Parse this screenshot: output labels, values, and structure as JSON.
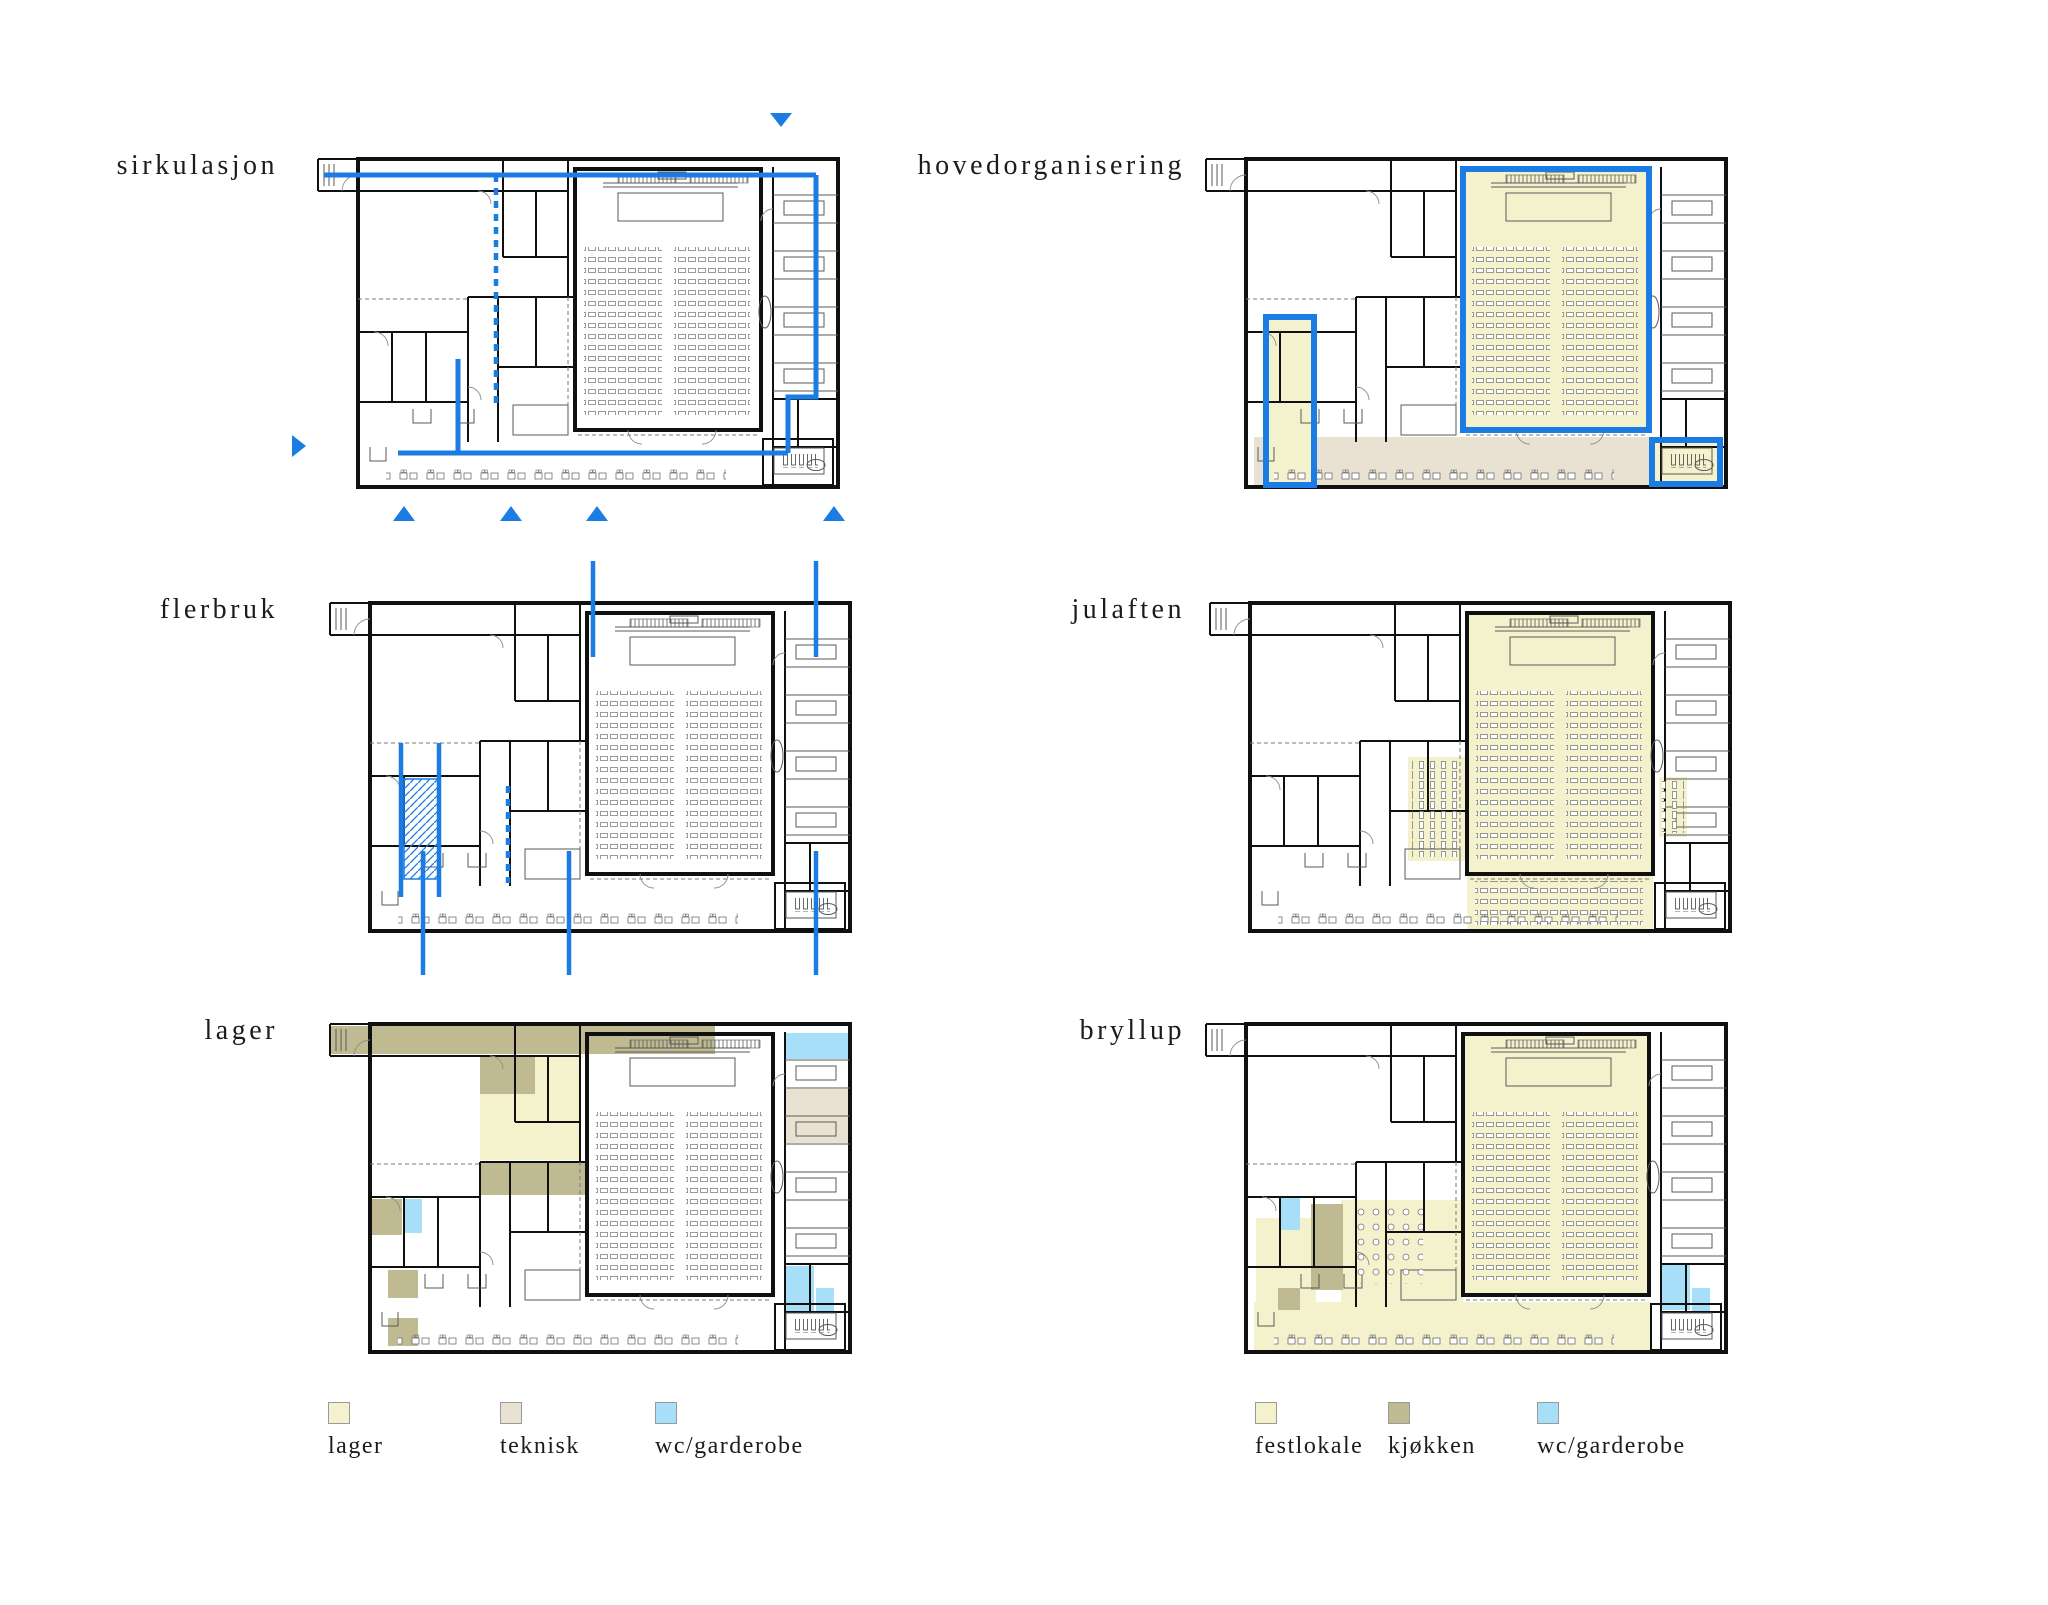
{
  "page": {
    "background": "#ffffff",
    "width": 2048,
    "height": 1605
  },
  "colors": {
    "circulation_blue": "#1b7de4",
    "pale_yellow": "#f4f1cd",
    "beige": "#e9e1d2",
    "olive": "#bfba92",
    "light_blue": "#a6dff7",
    "wall_black": "#101010",
    "line_gray": "#5a5a5a",
    "label_text": "#1c1c1c"
  },
  "plans": [
    {
      "id": "sirkulasjon",
      "label": "sirkulasjon"
    },
    {
      "id": "hovedorganisering",
      "label": "hovedorganisering"
    },
    {
      "id": "flerbruk",
      "label": "flerbruk"
    },
    {
      "id": "julaften",
      "label": "julaften"
    },
    {
      "id": "lager",
      "label": "lager"
    },
    {
      "id": "bryllup",
      "label": "bryllup"
    }
  ],
  "legends": {
    "left": {
      "items": [
        {
          "label": "lager",
          "color": "#f4f1cd",
          "color_key": "pale_yellow"
        },
        {
          "label": "teknisk",
          "color": "#e9e1d2",
          "color_key": "beige"
        },
        {
          "label": "wc/garderobe",
          "color": "#a6dff7",
          "color_key": "light_blue"
        }
      ]
    },
    "right": {
      "items": [
        {
          "label": "festlokale",
          "color": "#f4f1cd",
          "color_key": "pale_yellow"
        },
        {
          "label": "kjøkken",
          "color": "#bfba92",
          "color_key": "olive"
        },
        {
          "label": "wc/garderobe",
          "color": "#a6dff7",
          "color_key": "light_blue"
        }
      ]
    }
  }
}
